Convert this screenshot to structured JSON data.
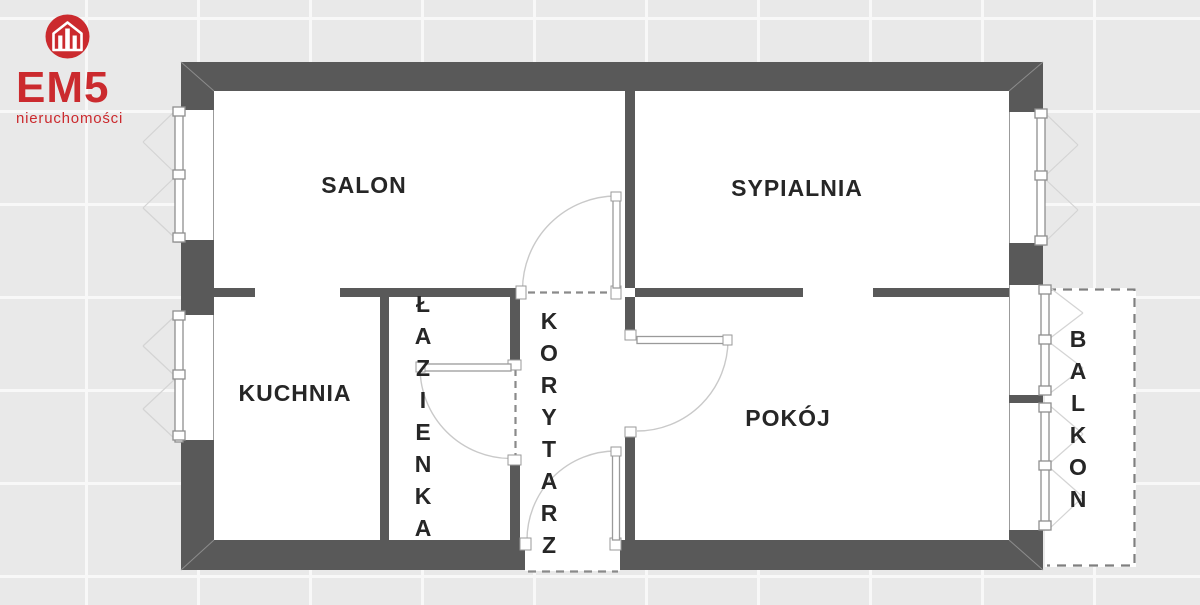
{
  "logo": {
    "title": "EM5",
    "subtitle": "nieruchomości",
    "icon": "house-icon",
    "brand_color": "#cb2a2e"
  },
  "floorplan": {
    "type": "apartment-floor-plan",
    "rooms": [
      {
        "id": "salon",
        "name": "SALON",
        "label_orientation": "horizontal"
      },
      {
        "id": "sypialnia",
        "name": "SYPIALNIA",
        "label_orientation": "horizontal"
      },
      {
        "id": "kuchnia",
        "name": "KUCHNIA",
        "label_orientation": "horizontal"
      },
      {
        "id": "lazienka",
        "name": "ŁAZIENKA",
        "label_orientation": "vertical"
      },
      {
        "id": "korytarz",
        "name": "KORYTARZ",
        "label_orientation": "vertical"
      },
      {
        "id": "pokoj",
        "name": "POKÓJ",
        "label_orientation": "horizontal"
      },
      {
        "id": "balkon",
        "name": "BALKON",
        "label_orientation": "vertical"
      }
    ],
    "colors": {
      "wall": "#595959",
      "interior": "#ffffff",
      "background_tile": "#e9e9e9",
      "tile_seam": "#f8f8f8",
      "label_text": "#262626",
      "door_arc": "#c9c9c9",
      "dashed_opening": "#8a8a8a"
    }
  }
}
